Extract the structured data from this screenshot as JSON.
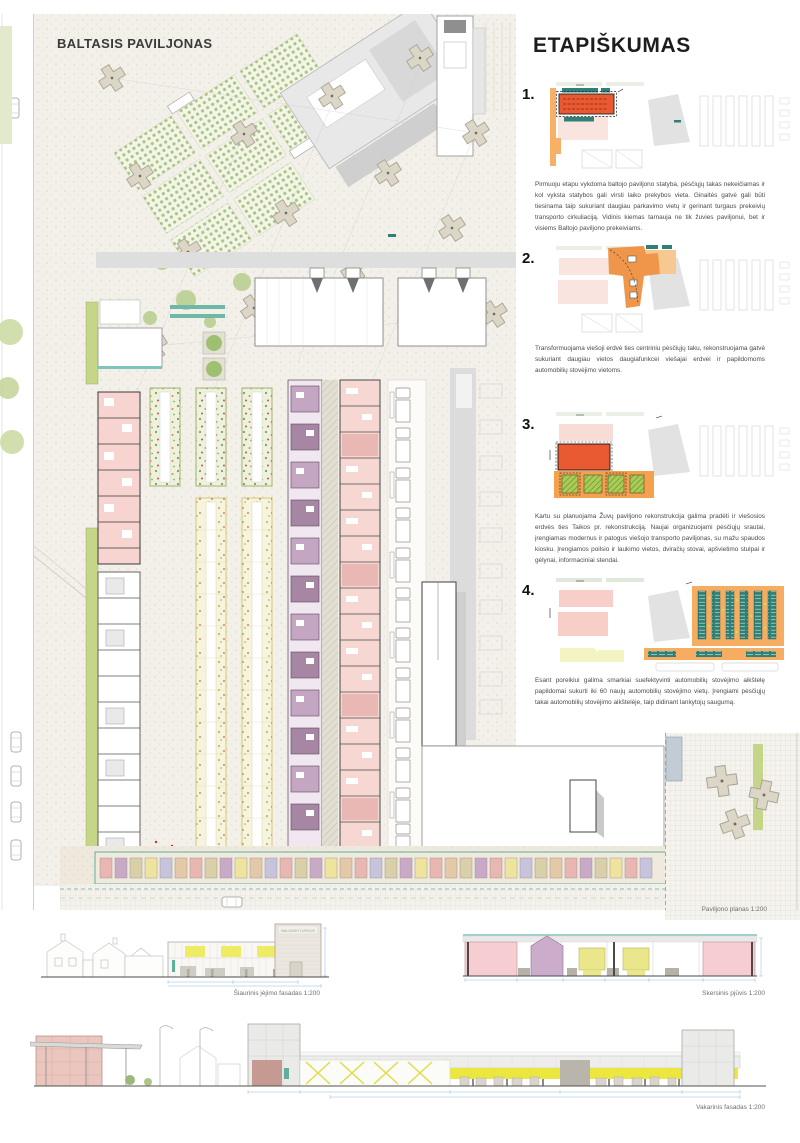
{
  "poster": {
    "plan_title": "BALTASIS PAVILJONAS",
    "plan_caption": "Paviljono planas 1:200"
  },
  "phasing": {
    "heading": "ETAPIŠKUMAS",
    "phases": [
      {
        "number": "1.",
        "text": "Pirmuoju etapu vykdoma baltojo paviljono statyba, pėsčiųjų takas nekeičiamas ir kol vyksta statybos gali virsti laiko prekybos vieta. Ginaitės gatvė gali būti tiesinama taip sukuriant daugiau parkavimo vietų ir gerinant turgaus prekeivių transporto cirkuliaciją. Vidinis kiemas tarnauja ne tik žuvies paviljonui, bet ir visiems Baltojo paviljono prekeiviams."
      },
      {
        "number": "2.",
        "text": "Transformuojama viešoji erdvė ties centriniu pėsčiųjų taku, rekonstruojama gatvė sukuriant daugiau vietos daugiafunkcei viešajai erdvei ir papildomoms automobilių stovėjimo vietoms."
      },
      {
        "number": "3.",
        "text": "Kartu su planuojama Žuvų paviljono rekonstrukcija galima pradėti ir viešosios erdvės ties Taikos pr. rekonstrukciją. Naujai organizuojami pėsčiųjų srautai, įrengiamas modernus ir patogus viešojo transporto paviljonas, su mažu spaudos kiosku. Įrengiamos poilsio ir laukimo vietos, dviračių stovai, apšvietimo stulpai ir gėlynai, informaciniai stendai."
      },
      {
        "number": "4.",
        "text": "Esant poreikiui galima smarkiai suefektyvinti automobilių stovėjimo aikštelę papildomai sukurti iki 60 naujų automobilių stovėjimo vietų. Įrengiami pėsčiųjų takai automobilių stovėjimo aikštelėje, taip didinant lankytojų saugumą."
      }
    ]
  },
  "elevations": {
    "north": {
      "caption": "Šiaurinis įėjimo fasadas 1:200",
      "sign_text": "NAUJASIS TURGUS"
    },
    "section": {
      "caption": "Skersinis pjūvis 1:200"
    },
    "west": {
      "caption": "Vakarinis fasadas 1:200"
    }
  },
  "colors": {
    "accent_orange": "#F2994A",
    "accent_red_orange": "#EB5A33",
    "accent_teal": "#2F8076",
    "pink_light": "#F7D6D1",
    "purple_stall": "#C4A5C2",
    "yellow_light": "#F4F3C2",
    "facade_yellow": "#ECE73F",
    "gray_building": "#DCDCDC",
    "green_landscape": "#A9CC55"
  }
}
